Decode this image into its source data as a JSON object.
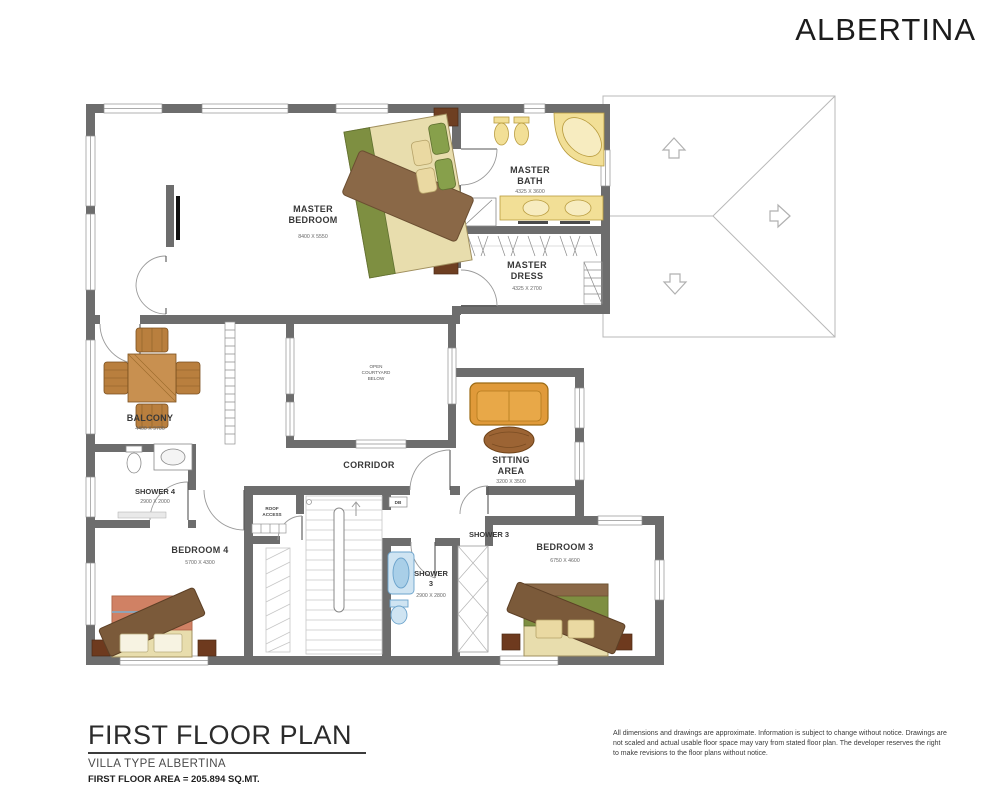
{
  "header": {
    "brand": "ALBERTINA"
  },
  "plan": {
    "rooms": {
      "master_bedroom": {
        "lines": [
          "MASTER",
          "BEDROOM"
        ],
        "dim": "8400 X 5550"
      },
      "master_bath": {
        "lines": [
          "MASTER",
          "BATH"
        ],
        "dim": "4325 X 3600"
      },
      "master_dress": {
        "lines": [
          "MASTER",
          "DRESS"
        ],
        "dim": "4325 X 2700"
      },
      "balcony": {
        "name": "BALCONY",
        "dim": "4400 X 9700"
      },
      "shower4": {
        "name": "SHOWER 4",
        "dim": "2900 X 2000"
      },
      "bedroom4": {
        "name": "BEDROOM 4",
        "dim": "5700 X 4300"
      },
      "corridor": {
        "name": "CORRIDOR"
      },
      "courtyard": {
        "lines": [
          "OPEN",
          "COURTYARD",
          "BELOW"
        ]
      },
      "sitting": {
        "lines": [
          "SITTING",
          "AREA"
        ],
        "dim": "3200 X 3500"
      },
      "shower3_tag": {
        "name": "SHOWER 3"
      },
      "shower3": {
        "lines": [
          "SHOWER",
          "3"
        ],
        "dim": "2900 X 2800"
      },
      "bedroom3": {
        "name": "BEDROOM 3",
        "dim": "6750 X 4600"
      },
      "roof_access": {
        "lines": [
          "ROOF",
          "ACCESS"
        ]
      },
      "db": {
        "name": "DB"
      }
    }
  },
  "footer": {
    "title": "FIRST FLOOR PLAN",
    "subtitle": "VILLA TYPE ALBERTINA",
    "area": "FIRST FLOOR AREA = 205.894 SQ.MT.",
    "disclaimer": "All dimensions and drawings are approximate. Information is subject to change without notice. Drawings are not scaled and actual usable floor space may vary from stated floor plan. The developer reserves the right to make revisions to the floor plans without notice."
  },
  "colors": {
    "wall": "#6d6d6d",
    "fixture_yellow": "#f2df96",
    "wood": "#c89050",
    "green": "#7e8f41",
    "salmon": "#d08164",
    "orange": "#e09a3a",
    "blue": "#cfe4f2",
    "roof_line": "#b8b8b8"
  }
}
